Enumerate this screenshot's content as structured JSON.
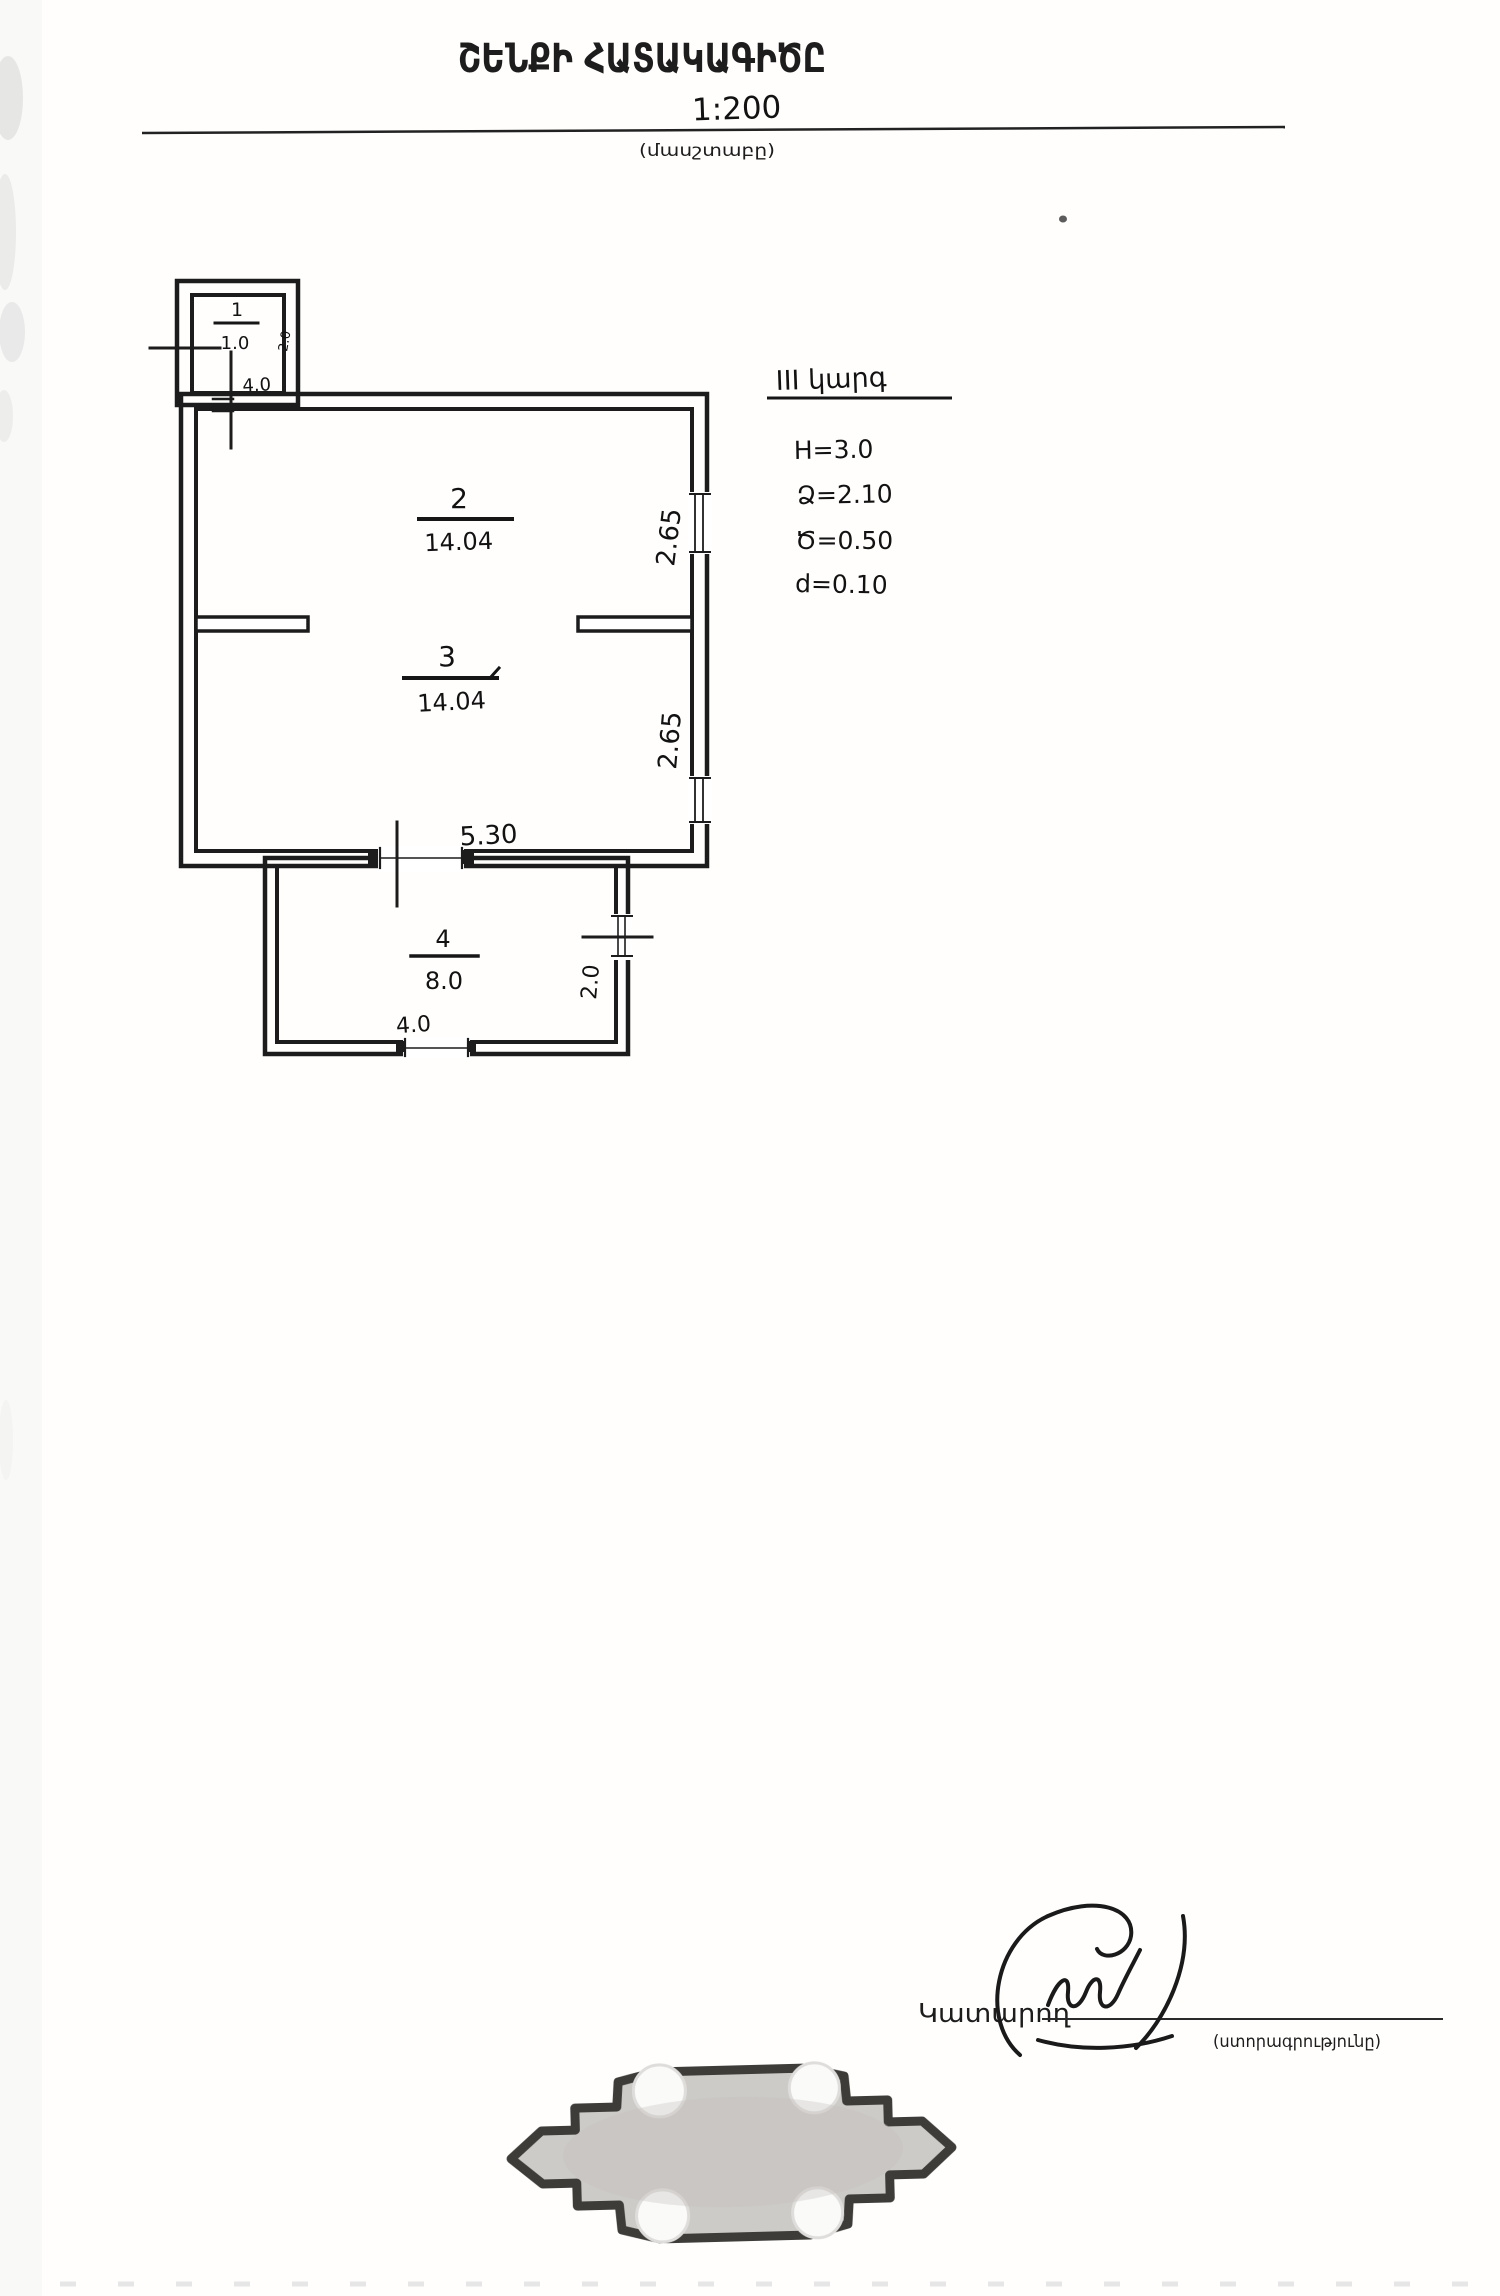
{
  "document": {
    "title": "ՇԵՆՔԻ ՀԱՏԱԿԱԳԻԾԸ",
    "scale": {
      "value": "1:200",
      "caption": "(մասշտաբը)"
    }
  },
  "plan": {
    "rooms": [
      {
        "number": "1",
        "area": "1.0"
      },
      {
        "number": "2",
        "area": "14.04"
      },
      {
        "number": "3",
        "area": "14.04"
      },
      {
        "number": "4",
        "area": "8.0"
      }
    ],
    "dims": {
      "room1_width": "4.0",
      "room1_height": "2.0",
      "rooms_width": "5.30",
      "room2_height": "2.65",
      "room3_height": "2.65",
      "room4_width": "4.0",
      "room4_height": "2.0"
    }
  },
  "notes": {
    "heading": "III կարգ",
    "items": [
      "Н=3.0",
      "Ձ=2.10",
      "Ծ=0.50",
      "d=0.10"
    ]
  },
  "footer": {
    "executor_label": "Կատարող",
    "signature_caption": "(ստորագրությունը)"
  },
  "colors": {
    "ink": "#1c1c1c",
    "stamp_fill": "#c9c7c3",
    "stamp_border": "#2e2c29"
  }
}
